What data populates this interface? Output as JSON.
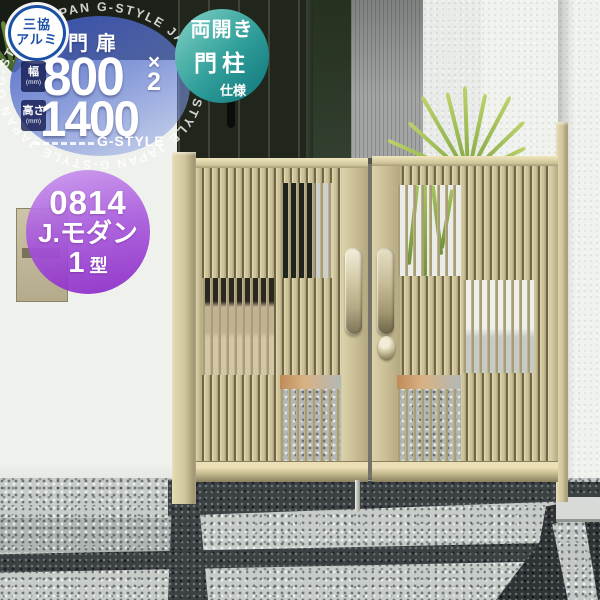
{
  "brand_badge": {
    "line1": "三協",
    "line2": "アルミ"
  },
  "spec_circle": {
    "product_type": "門扉",
    "width": {
      "label": "幅",
      "unit": "(mm)",
      "value": "800",
      "times_symbol": "×",
      "count": "2"
    },
    "height": {
      "label": "高さ",
      "unit": "(mm)",
      "value": "1400"
    },
    "brand": "G-STYLE"
  },
  "type_circle": {
    "line1": "両開き",
    "line2": "門柱",
    "line3": "仕様"
  },
  "model_circle": {
    "code": "0814",
    "name": "J.モダン",
    "type_number": "1",
    "type_suffix": "型"
  },
  "watermark": {
    "text": "G-STYLE JAPAN",
    "ring": "G-STYLE JAPAN   G-STYLE JAPAN   G-STYLE JAPAN   G-STYLE JAPAN   G-STYLE JAPAN   G-STYLE JAPAN   G-STYLE JAPAN"
  },
  "colors": {
    "gate_champagne": "#cfc49a",
    "badge_blue": "#4c63be",
    "badge_teal": "#2f9d99",
    "badge_purple": "#a858dc",
    "brand_blue": "#1a50a5"
  }
}
